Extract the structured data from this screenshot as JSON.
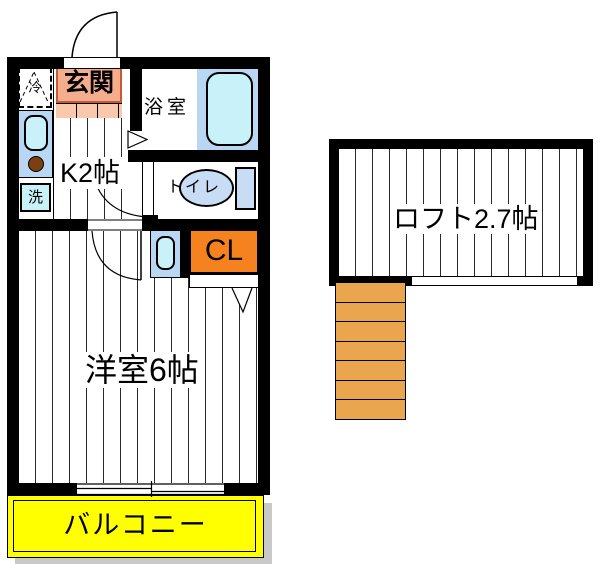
{
  "rooms": {
    "entrance": "玄関",
    "kitchen": "K2帖",
    "bath": "浴室",
    "toilet": "トイレ",
    "closet": "CL",
    "bedroom": "洋室6帖",
    "balcony": "バルコニー",
    "loft": "ロフト2.7帖"
  },
  "appliances": {
    "fridge": "冷",
    "washer": "洗"
  },
  "colors": {
    "wall": "#000000",
    "entrance_fill": "#f5ad8c",
    "entrance_border": "#c85a32",
    "closet_fill": "#f5821f",
    "balcony_fill": "#ffff00",
    "stairs_fill": "#eaa64f",
    "bath_floor": "#b9d7f2",
    "bathtub_fill": "#c9f1f9",
    "toilet_fixture_fill": "#c8dcf5",
    "burner_fill": "#7b3f10"
  }
}
